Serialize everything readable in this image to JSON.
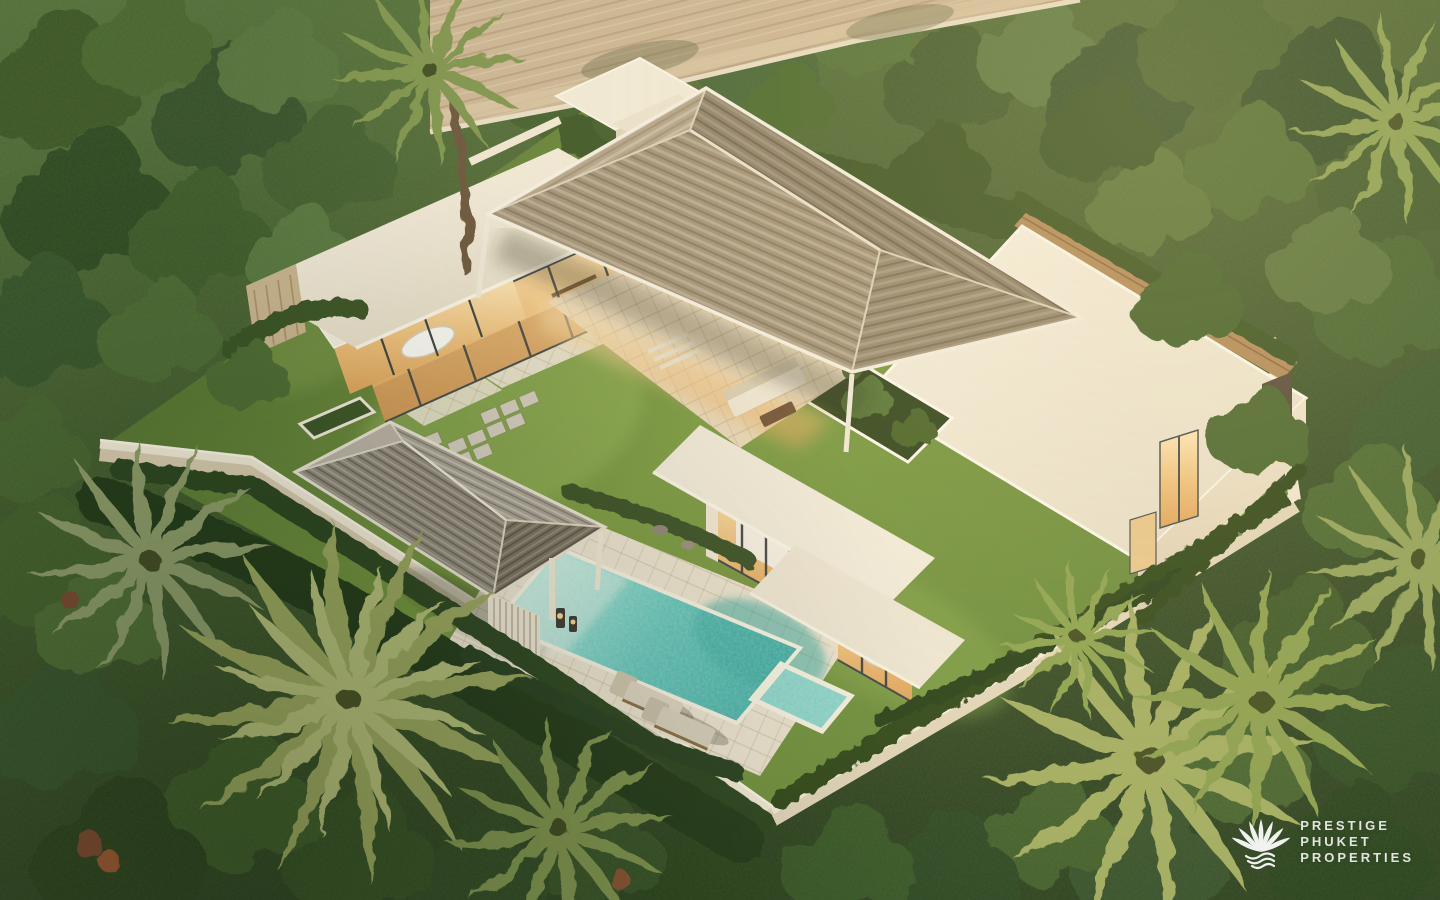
{
  "meta": {
    "image_type": "3d-architectural-aerial-render",
    "subject": "modern tropical pool villa in walled jungle garden at golden hour"
  },
  "watermark": {
    "icon": "shell-logo-icon",
    "lines": [
      "PRESTIGE",
      "PHUKET",
      "PROPERTIES"
    ]
  },
  "palette": {
    "foliage_dark": "#2e4323",
    "foliage_mid": "#49632f",
    "foliage_light": "#7e9850",
    "palm_yellow": "#a3ae64",
    "lawn": "#7b9a46",
    "pool_water": "#56c2ba",
    "pool_deep": "#2aa39c",
    "deck": "#ece4d2",
    "wall_white": "#f1eadb",
    "roof_shingle": "#a3947c",
    "roof_shadow": "#8e816c",
    "sala_slat": "#908a7d",
    "warm_glow": "#f3cf96",
    "road": "#c9b494",
    "wood_deck": "#b28b5b",
    "watermark_white": "#ffffff"
  }
}
